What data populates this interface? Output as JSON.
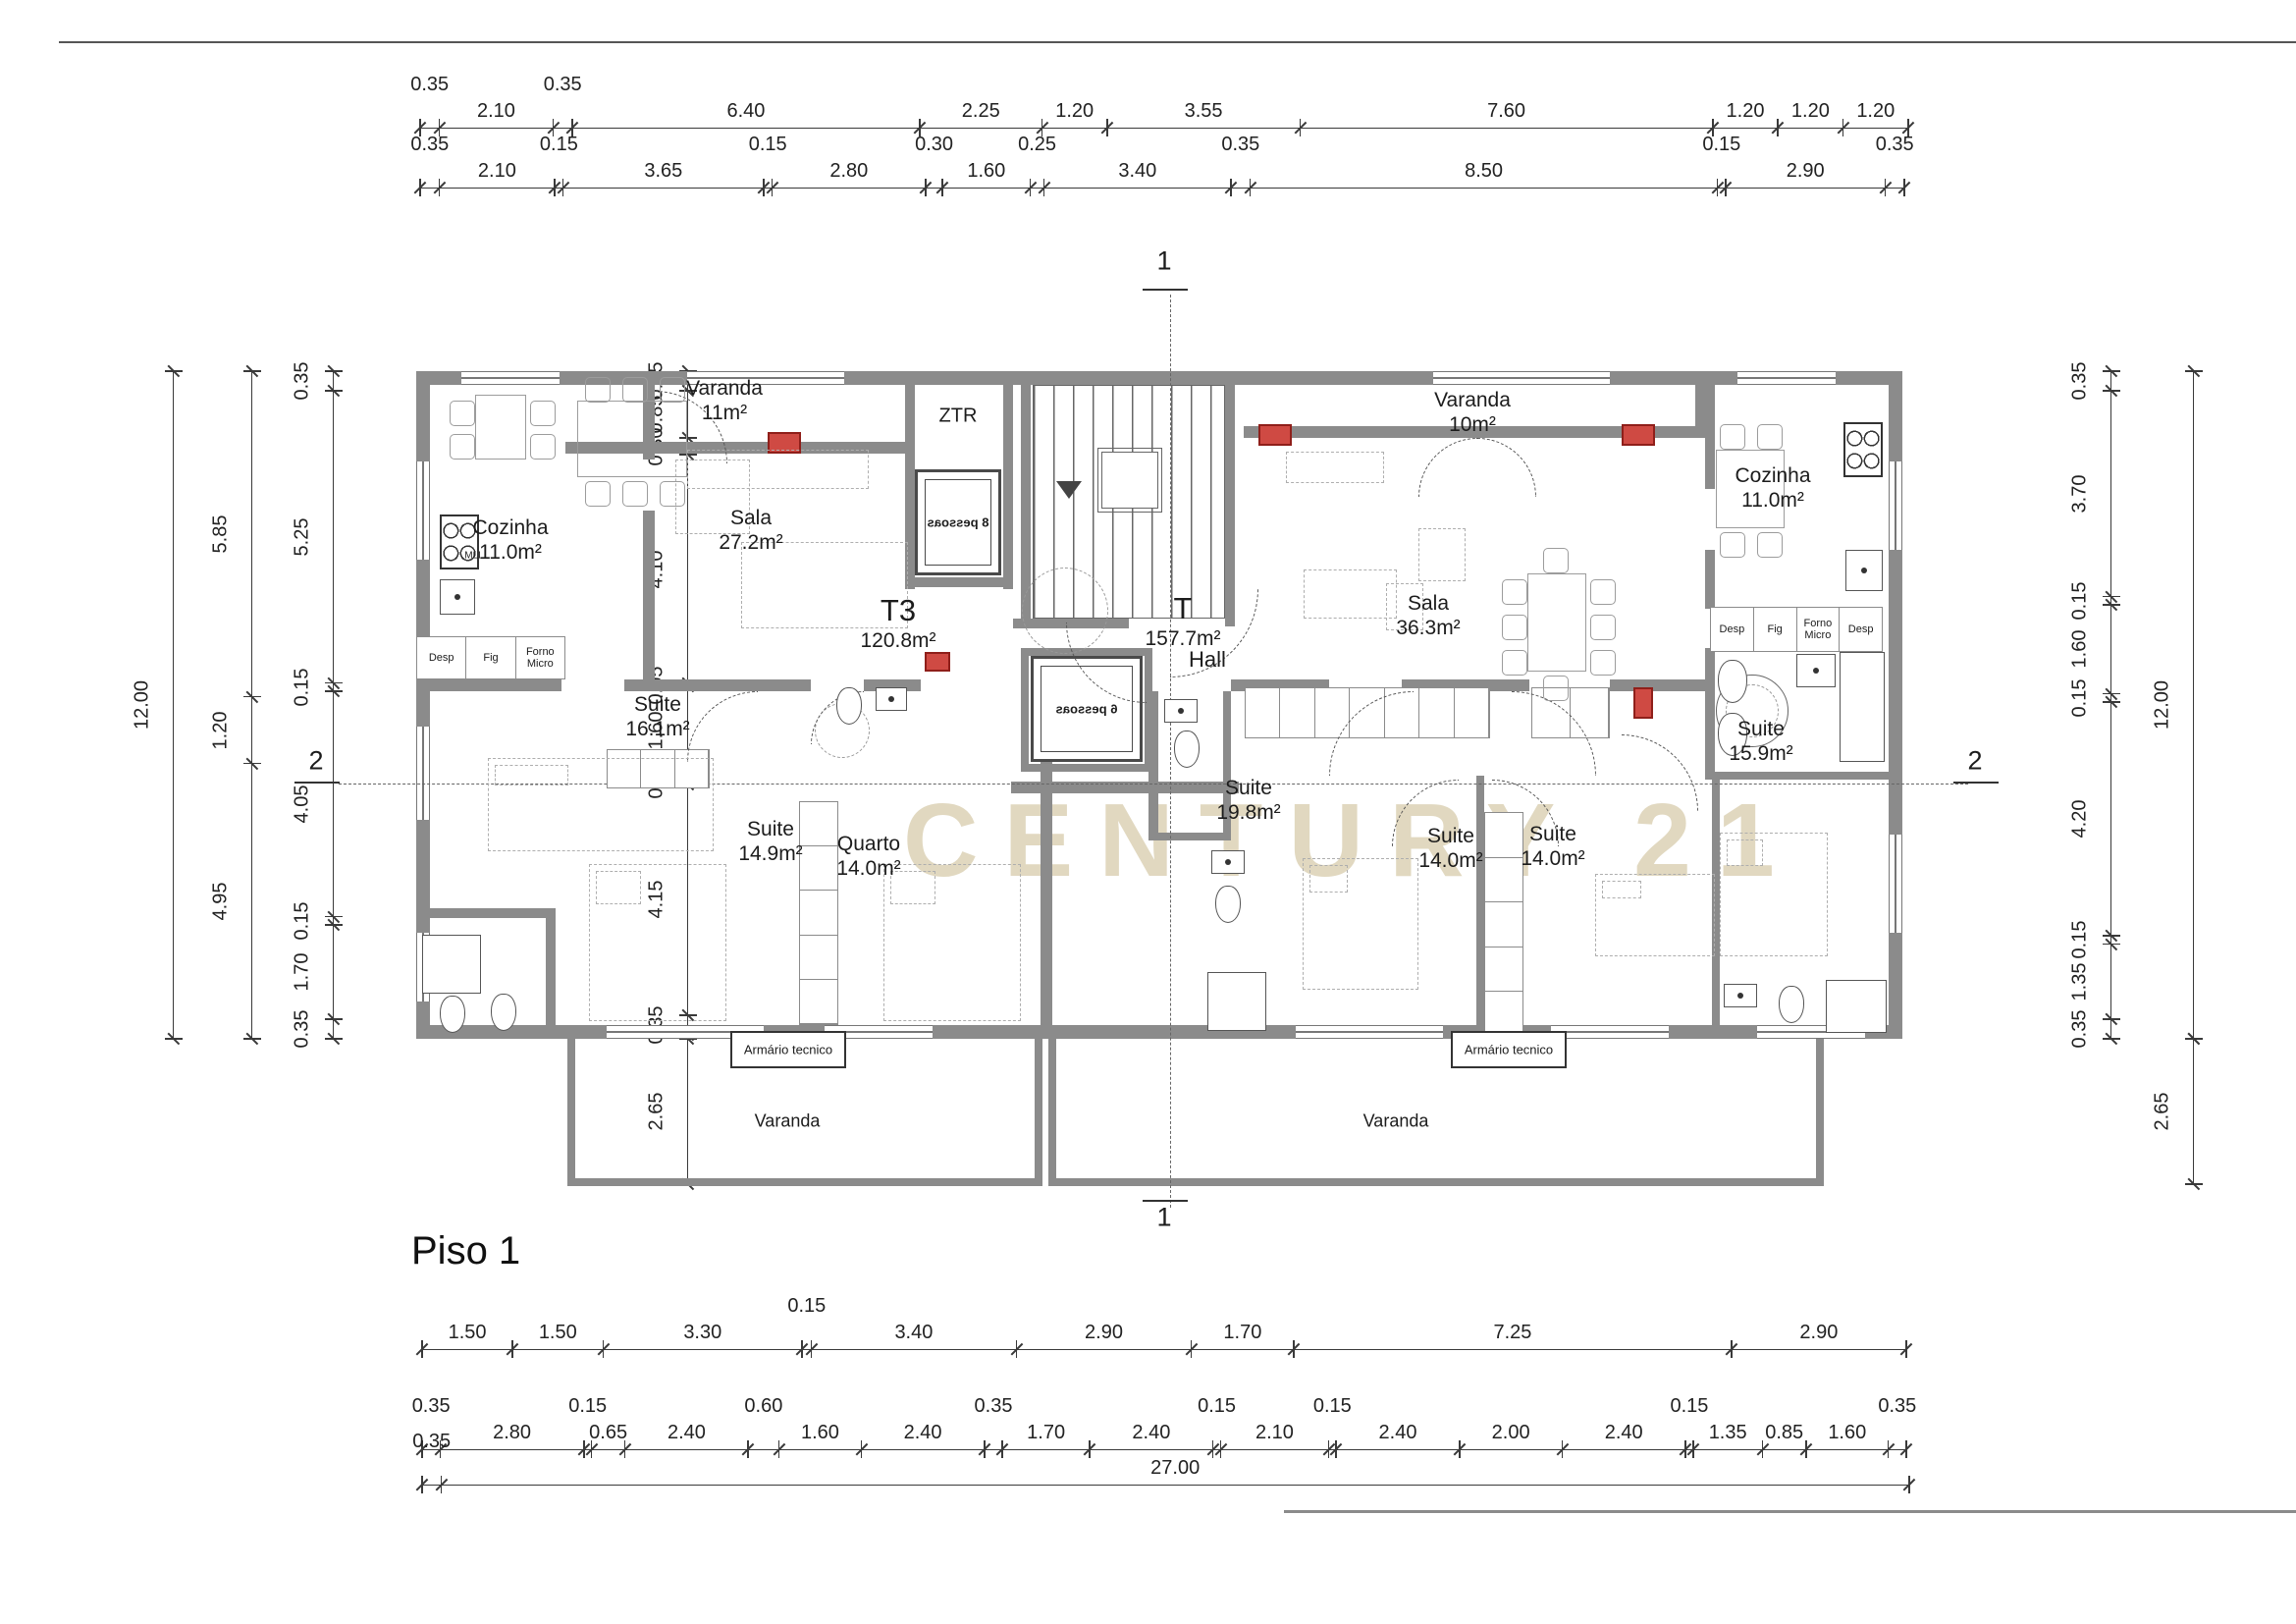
{
  "title": "Piso 1",
  "watermark": "CENTURY 21",
  "section_markers": {
    "vertical": "1",
    "horizontal": "2"
  },
  "core": {
    "ztr": "ZTR",
    "elevator_top": "8 pessoas",
    "elevator_bottom": "6 pessoas",
    "hall": "Hall"
  },
  "rooms": {
    "varanda_tl": {
      "label": "Varanda",
      "area": "11m²"
    },
    "cozinha_left": {
      "label": "Cozinha",
      "area": "11.0m²"
    },
    "mll": "MLL",
    "sala_left": {
      "label": "Sala",
      "area": "27.2m²"
    },
    "t3": {
      "label": "T3",
      "area": "120.8m²"
    },
    "suite_161": {
      "label": "Suite",
      "area": "16.1m²"
    },
    "suite_149": {
      "label": "Suite",
      "area": "14.9m²"
    },
    "quarto_140": {
      "label": "Quarto",
      "area": "14.0m²"
    },
    "t4": {
      "label": "T",
      "area": "157.7m²"
    },
    "hall": "Hall",
    "varanda_tr": {
      "label": "Varanda",
      "area": "10m²"
    },
    "sala_right": {
      "label": "Sala",
      "area": "36.3m²"
    },
    "cozinha_right": {
      "label": "Cozinha",
      "area": "11.0m²"
    },
    "suite_198": {
      "label": "Suite",
      "area": "19.8m²"
    },
    "suite_140a": {
      "label": "Suite",
      "area": "14.0m²"
    },
    "suite_140b": {
      "label": "Suite",
      "area": "14.0m²"
    },
    "suite_159": {
      "label": "Suite",
      "area": "15.9m²"
    },
    "armario_left": "Armário tecnico",
    "armario_right": "Armário tecnico",
    "varanda_bl": "Varanda",
    "varanda_br": "Varanda"
  },
  "kitchen": {
    "left_cells": [
      "Desp",
      "Fig",
      "Forno Micro"
    ],
    "right_cells": [
      "Desp",
      "Fig",
      "Forno Micro",
      "Desp"
    ]
  },
  "dimensions": {
    "top_row_1": [
      {
        "v": "0.35",
        "up": true
      },
      {
        "v": "2.10"
      },
      {
        "v": "0.35",
        "up": true
      },
      {
        "v": "6.40"
      },
      {
        "v": "2.25"
      },
      {
        "v": "1.20"
      },
      {
        "v": "3.55"
      },
      {
        "v": "7.60"
      },
      {
        "v": "1.20"
      },
      {
        "v": "1.20"
      },
      {
        "v": "1.20"
      }
    ],
    "top_row_2": [
      {
        "v": "0.35",
        "up": true
      },
      {
        "v": "2.10"
      },
      {
        "v": "0.15",
        "up": true
      },
      {
        "v": "3.65"
      },
      {
        "v": "0.15",
        "up": true
      },
      {
        "v": "2.80"
      },
      {
        "v": "0.30",
        "up": true
      },
      {
        "v": "1.60"
      },
      {
        "v": "0.25",
        "up": true
      },
      {
        "v": "3.40"
      },
      {
        "v": "0.35",
        "up": true
      },
      {
        "v": "8.50"
      },
      {
        "v": "0.15",
        "up": true
      },
      {
        "v": "2.90"
      },
      {
        "v": "0.35",
        "up": true
      }
    ],
    "bottom_row_1": [
      {
        "v": "1.50"
      },
      {
        "v": "1.50"
      },
      {
        "v": "3.30"
      },
      {
        "v": "0.15",
        "up": true
      },
      {
        "v": "3.40"
      },
      {
        "v": "2.90"
      },
      {
        "v": "1.70"
      },
      {
        "v": "7.25"
      },
      {
        "v": "2.90"
      }
    ],
    "bottom_row_2": [
      {
        "v": "0.35",
        "up": true
      },
      {
        "v": "2.80"
      },
      {
        "v": "0.15",
        "up": true
      },
      {
        "v": "0.65"
      },
      {
        "v": "2.40"
      },
      {
        "v": "0.60",
        "up": true
      },
      {
        "v": "1.60"
      },
      {
        "v": "2.40"
      },
      {
        "v": "0.35",
        "up": true
      },
      {
        "v": "1.70"
      },
      {
        "v": "2.40"
      },
      {
        "v": "0.15",
        "up": true
      },
      {
        "v": "2.10"
      },
      {
        "v": "0.15",
        "up": true
      },
      {
        "v": "2.40"
      },
      {
        "v": "2.00"
      },
      {
        "v": "2.40"
      },
      {
        "v": "0.15",
        "up": true
      },
      {
        "v": "1.35"
      },
      {
        "v": "0.85"
      },
      {
        "v": "1.60"
      },
      {
        "v": "0.35",
        "up": true
      }
    ],
    "bottom_row_3": [
      {
        "v": "0.35",
        "up": true
      },
      {
        "v": "27.00"
      }
    ],
    "left_total": [
      {
        "v": "12.00"
      }
    ],
    "left_mid": [
      {
        "v": "5.85"
      },
      {
        "v": "1.20"
      },
      {
        "v": "4.95"
      }
    ],
    "left_inner": [
      {
        "v": "0.35",
        "up": true
      },
      {
        "v": "5.25"
      },
      {
        "v": "0.15",
        "up": true
      },
      {
        "v": "4.05"
      },
      {
        "v": "0.15",
        "up": true
      },
      {
        "v": "1.70"
      },
      {
        "v": "0.35",
        "up": true
      }
    ],
    "left_wall": [
      {
        "v": "0.35",
        "up": true
      },
      {
        "v": "0.85"
      },
      {
        "v": "0.30",
        "up": true
      },
      {
        "v": "4.10"
      },
      {
        "v": "0.05",
        "up": true
      },
      {
        "v": "1.60"
      },
      {
        "v": "0.15",
        "up": true
      },
      {
        "v": "4.15"
      },
      {
        "v": "0.35",
        "up": true
      }
    ],
    "left_balcony": [
      {
        "v": "2.65"
      }
    ],
    "right_inner": [
      {
        "v": "0.35",
        "up": true
      },
      {
        "v": "3.70"
      },
      {
        "v": "0.15",
        "up": true
      },
      {
        "v": "1.60"
      },
      {
        "v": "0.15",
        "up": true
      },
      {
        "v": "4.20"
      },
      {
        "v": "0.15",
        "up": true
      },
      {
        "v": "1.35"
      },
      {
        "v": "0.35",
        "up": true
      }
    ],
    "right_total": [
      {
        "v": "12.00"
      }
    ],
    "right_balcony": [
      {
        "v": "2.65"
      }
    ]
  }
}
